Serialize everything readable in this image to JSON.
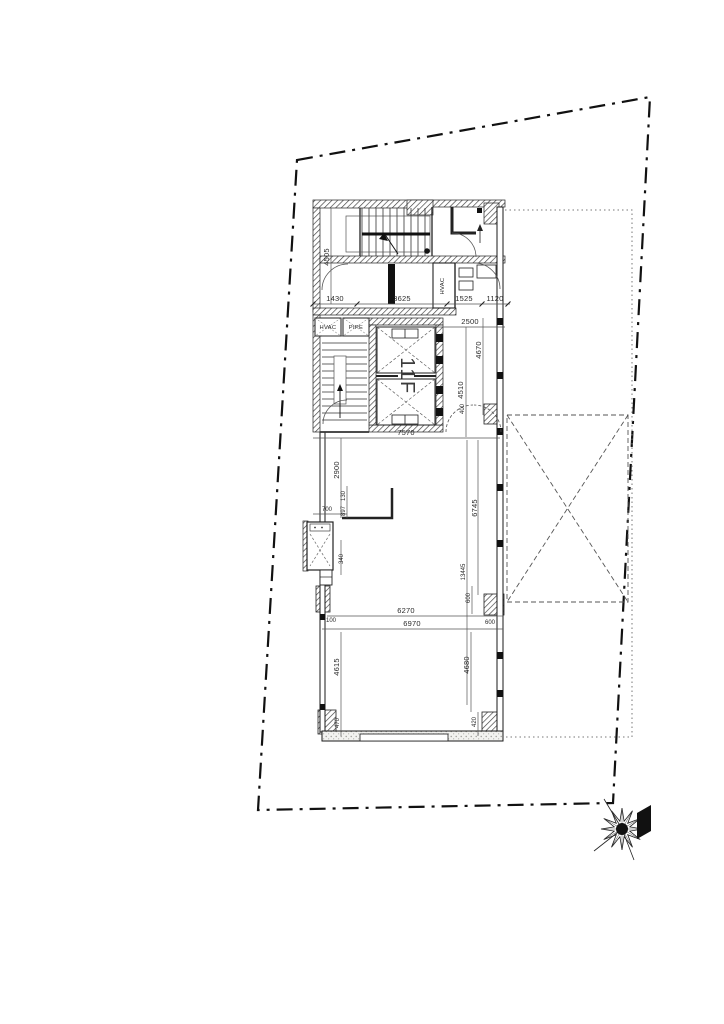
{
  "drawing": {
    "floor_label": "11F",
    "labels": {
      "hvac_small": "HVAC",
      "pipe_small": "PIPE",
      "hvac_room": "HVAC"
    },
    "dims": {
      "d4505": "4505",
      "d1430": "1430",
      "d3625": "3625",
      "d1525": "1525",
      "d1120": "1120",
      "d2500": "2500",
      "d4670": "4670",
      "d4510": "4510",
      "d400": "400",
      "d7570": "7570",
      "d2900": "2900",
      "d700": "700",
      "d130": "130",
      "d897": "897",
      "d340": "340",
      "d6745": "6745",
      "d13445": "13445",
      "d600v": "600",
      "d600h": "600",
      "d100": "100",
      "d6270": "6270",
      "d6970": "6970",
      "d4615": "4615",
      "d4680": "4680",
      "d470": "470",
      "d420": "420"
    },
    "colors": {
      "line": "#1a1a1a",
      "dim_line": "#444444",
      "hatch": "#3a3a3a"
    }
  }
}
